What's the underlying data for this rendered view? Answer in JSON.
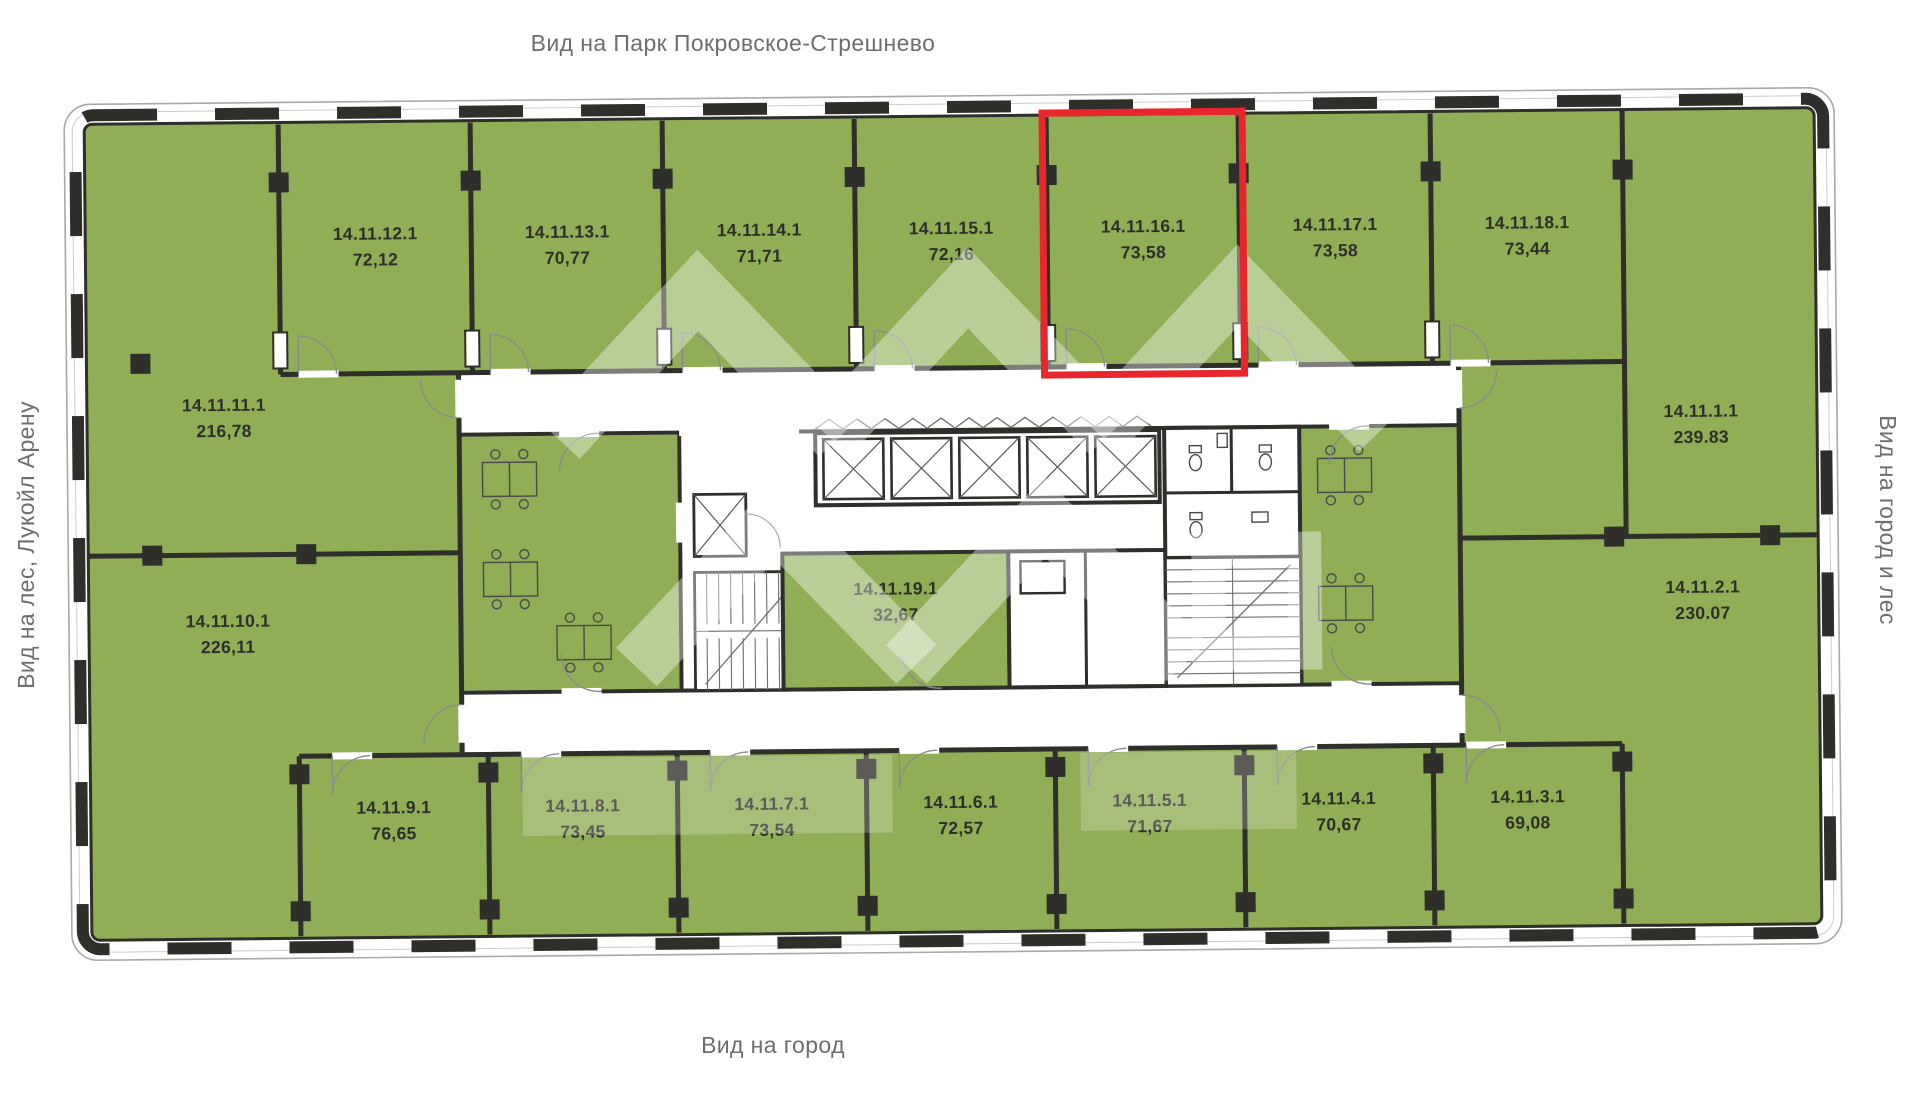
{
  "captions": {
    "top": "Вид на Парк Покровское-Стрешнево",
    "bottom": "Вид на город",
    "left": "Вид на лес, Лукойл Арену",
    "right": "Вид на город и лес"
  },
  "plan": {
    "highlighted_unit": "14.11.16.1",
    "colors": {
      "unit_fill": "#8FAE56",
      "wall": "#2E2E2A",
      "highlight": "#E8262B",
      "caption_text": "#6E6E6E",
      "label_text": "#2E2E2A",
      "watermark": "#FFFFFF"
    },
    "top_units": [
      {
        "id": "14.11.12.1",
        "area": "72,12"
      },
      {
        "id": "14.11.13.1",
        "area": "70,77"
      },
      {
        "id": "14.11.14.1",
        "area": "71,71"
      },
      {
        "id": "14.11.15.1",
        "area": "72,16"
      },
      {
        "id": "14.11.16.1",
        "area": "73,58"
      },
      {
        "id": "14.11.17.1",
        "area": "73,58"
      },
      {
        "id": "14.11.18.1",
        "area": "73,44"
      }
    ],
    "bottom_units": [
      {
        "id": "14.11.9.1",
        "area": "76,65"
      },
      {
        "id": "14.11.8.1",
        "area": "73,45"
      },
      {
        "id": "14.11.7.1",
        "area": "73,54"
      },
      {
        "id": "14.11.6.1",
        "area": "72,57"
      },
      {
        "id": "14.11.5.1",
        "area": "71,67"
      },
      {
        "id": "14.11.4.1",
        "area": "70,67"
      },
      {
        "id": "14.11.3.1",
        "area": "69,08"
      }
    ],
    "left_units": [
      {
        "id": "14.11.11.1",
        "area": "216,78"
      },
      {
        "id": "14.11.10.1",
        "area": "226,11"
      }
    ],
    "right_units": [
      {
        "id": "14.11.1.1",
        "area": "239.83"
      },
      {
        "id": "14.11.2.1",
        "area": "230.07"
      }
    ],
    "core_units": [
      {
        "id": "14.11.19.1",
        "area": "32,67"
      }
    ]
  }
}
